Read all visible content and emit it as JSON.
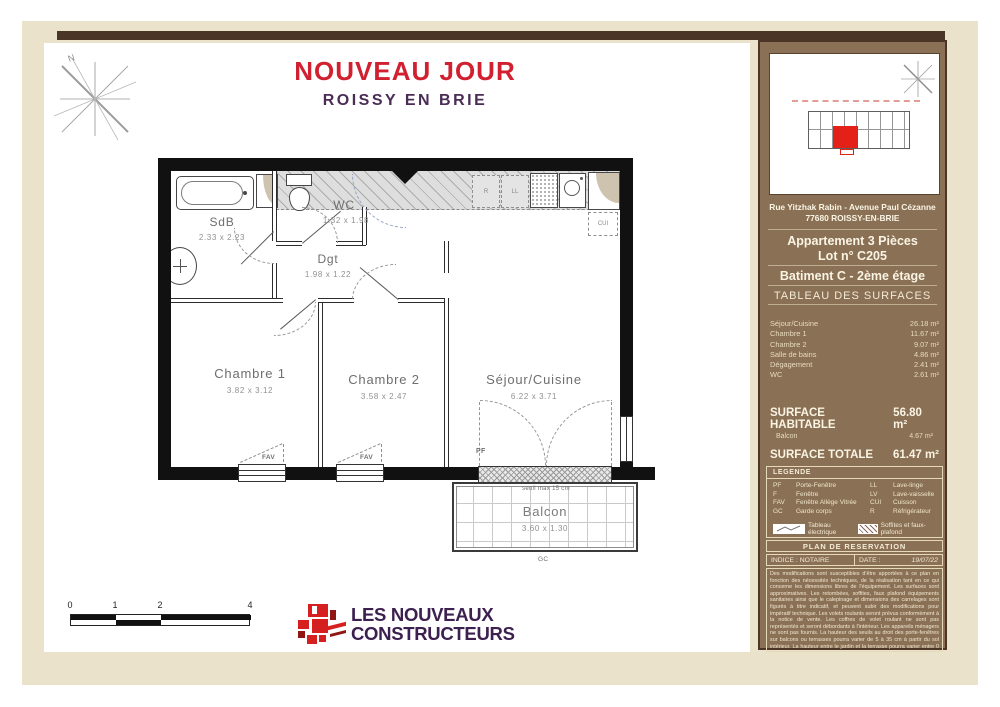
{
  "title": {
    "project": "NOUVEAU JOUR",
    "city": "ROISSY EN BRIE"
  },
  "compass": {
    "north": "N"
  },
  "plan": {
    "rooms": {
      "sdb": {
        "name": "SdB",
        "dims": "2.33 x  2.23"
      },
      "wc": {
        "name": "WC",
        "dims": "1.32 x  1.98"
      },
      "dgt": {
        "name": "Dgt",
        "dims": "1.98 x  1.22"
      },
      "chambre1": {
        "name": "Chambre 1",
        "dims": "3.82 x  3.12"
      },
      "chambre2": {
        "name": "Chambre 2",
        "dims": "3.58 x  2.47"
      },
      "sejour": {
        "name": "Séjour/Cuisine",
        "dims": "6.22 x  3.71"
      },
      "balcon": {
        "name": "Balcon",
        "dims": "3.60 x  1.30"
      }
    },
    "labels": {
      "pf": "PF",
      "fav": "FAV",
      "gc": "GC",
      "cui": "CUI",
      "ll": "LL",
      "r": "R",
      "seuil": "seuil max 15 cm"
    }
  },
  "scalebar": {
    "ticks": [
      "0",
      "1",
      "2",
      "4"
    ]
  },
  "logo": {
    "line1": "LES NOUVEAUX",
    "line2": "CONSTRUCTEURS"
  },
  "panel": {
    "address1": "Rue Yitzhak Rabin - Avenue Paul Cézanne",
    "address2": "77680 ROISSY-EN-BRIE",
    "apartment": "Appartement 3 Pièces",
    "lot": "Lot n° C205",
    "building": "Batiment C - 2ème étage",
    "table_title": "TABLEAU DES SURFACES",
    "surfaces": [
      {
        "label": "Séjour/Cuisine",
        "value": "26.18 m²"
      },
      {
        "label": "Chambre 1",
        "value": "11.67 m²"
      },
      {
        "label": "Chambre 2",
        "value": "9.07 m²"
      },
      {
        "label": "Salle de bains",
        "value": "4.86 m²"
      },
      {
        "label": "Dégagement",
        "value": "2.41 m²"
      },
      {
        "label": "WC",
        "value": "2.61 m²"
      }
    ],
    "habitable": {
      "label": "SURFACE HABITABLE",
      "value": "56.80 m²"
    },
    "balcon": {
      "label": "Balcon",
      "value": "4.67 m²"
    },
    "totale": {
      "label": "SURFACE TOTALE",
      "value": "61.47 m²"
    },
    "legend": {
      "title": "LEGENDE",
      "left": [
        {
          "abbr": "PF",
          "label": "Porte-Fenêtre"
        },
        {
          "abbr": "F",
          "label": "Fenêtre"
        },
        {
          "abbr": "FAV",
          "label": "Fenêtre Allège Vitrée"
        },
        {
          "abbr": "GC",
          "label": "Garde corps"
        }
      ],
      "right": [
        {
          "abbr": "LL",
          "label": "Lave-linge"
        },
        {
          "abbr": "LV",
          "label": "Lave-vaisselle"
        },
        {
          "abbr": "CUI",
          "label": "Cuisson"
        },
        {
          "abbr": "R",
          "label": "Réfrigérateur"
        }
      ],
      "electrical": "Tableau électrique",
      "soffit": "Soffites et faux-plafond"
    },
    "reservation": "PLAN DE RESERVATION",
    "indice": "INDICE : NOTAIRE",
    "date_label": "DATE :",
    "date_value": "19/07/22",
    "disclaimer": "Des modifications sont susceptibles d'être apportées à ce plan en fonction des nécessités techniques, de la réalisation tant en ce qui concerne les dimensions libres de l'équipement. Les surfaces sont approximatives. Les retombées, soffites, faux plafond équipements sanitaires ainsi que le calepinage et dimensions des carrelages sont figurés à titre indicatif, et peuvent subir des modifications pour impératif technique. Les volets roulants seront prévus conformément à la notice de vente. Les coffres de volet roulant ne sont pas représentés et seront débordants à l'intérieur. Les appareils ménagers ne sont pas fournis. La hauteur des seuils au droit des porte-fenêtres sur balcons ou terrasses pourra varier de 5 à 35 cm à partir du sol intérieur. La hauteur entre le jardin et la terrasse pourra varier entre 0 et 60 cm. Les jardins ne seront pas nécessairement plats et pourront comporter des talus et des pentes."
  },
  "colors": {
    "accent_red": "#d1202f",
    "brand_purple": "#3c2050",
    "panel_brown": "#8a7055",
    "frame_beige": "#ebe2cb",
    "dark_brown": "#4a3526",
    "unit_red": "#e32119"
  }
}
